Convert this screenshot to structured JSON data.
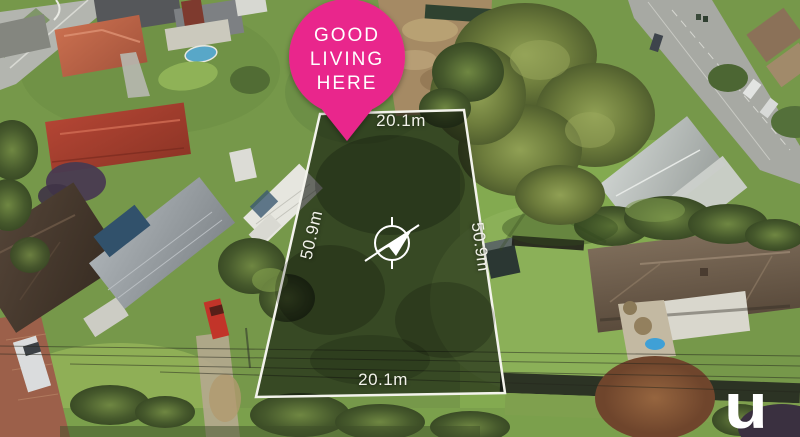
{
  "marker": {
    "icon": "location-pin-icon",
    "lines": [
      "GOOD",
      "LIVING",
      "HERE"
    ],
    "background_color": "#E9278C",
    "text_color": "#FFFFFF"
  },
  "dimensions": {
    "top": "20.1m",
    "bottom": "20.1m",
    "left": "50.9m",
    "right": "50.9m"
  },
  "overlay": {
    "boundary_color": "#F3F3EC",
    "compass_icon": "compass-north-arrow-icon"
  },
  "watermark": {
    "text": "u",
    "color": "#FFFFFF"
  }
}
